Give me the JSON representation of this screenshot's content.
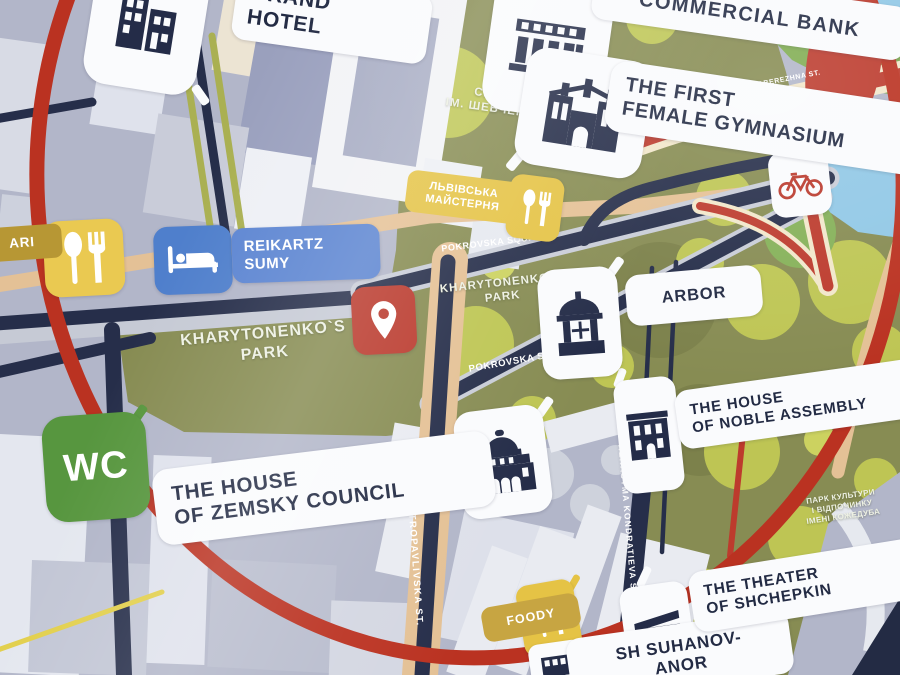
{
  "pois": {
    "grand_hotel": {
      "line1": "GRAND",
      "line2": "HOTEL",
      "icon": "modern-building"
    },
    "commercial_bank": {
      "label": "COMMERCIAL BANK",
      "icon": "bank-building"
    },
    "first_female_gymnasium": {
      "line1": "THE FIRST",
      "line2": "FEMALE GYMNASIUM",
      "icon": "towered-building"
    },
    "lvivska_maisternia": {
      "line1": "ЛЬВІВСЬКА",
      "line2": "МАЙСТЕРНЯ",
      "icon": "spoon-fork"
    },
    "restaurant_left": {
      "label": "ARI",
      "icon": "spoon-fork"
    },
    "reikartz_sumy": {
      "line1": "REIKARTZ",
      "line2": "SUMY",
      "icon": "bed"
    },
    "you_are_here": {
      "icon": "location-pin"
    },
    "arbor": {
      "label": "ARBOR",
      "icon": "gazebo"
    },
    "noble_assembly": {
      "line1": "THE HOUSE",
      "line2": "OF NOBLE ASSEMBLY",
      "icon": "mansion"
    },
    "wc": {
      "label": "WC"
    },
    "zemsky_council": {
      "line1": "THE HOUSE",
      "line2": "OF ZEMSKY COUNCIL",
      "icon": "domed-building"
    },
    "foody": {
      "label": "FOODY",
      "icon": "spoon-fork"
    },
    "theater_shchepkin": {
      "line1": "THE THEATER",
      "line2": "OF SHCHEPKIN",
      "icon": "theater-building"
    },
    "suhanov_manor": {
      "line1": "SH SUHANOV-",
      "line2": "ANOR",
      "icon": "building"
    },
    "bike_point": {
      "icon": "bicycle"
    },
    "route_marker": {
      "icon": "route-squiggle"
    }
  },
  "areas": {
    "shevchenko_square": {
      "line1": "СКВЕР",
      "line2": "ІМ. ШЕВЧЕНКА"
    },
    "kharytonenko_park": {
      "line1": "KHARYTONENKO`S",
      "line2": "PARK"
    },
    "kozhedub_park": {
      "line1": "ПАРК КУЛЬТУРИ",
      "line2": "І ВІДПОЧИНКУ",
      "line3": "ІМЕНІ КОЖЕДУБА"
    }
  },
  "streets": {
    "pokrovska_square": "POKROVSKA SQUARE",
    "petropavlivska": "PETROPAVLIVSKA ST.",
    "herasyma_kondratieva": "HERASYMA KONDRATIEVA ST.",
    "naberezhna": "NABEREZHNA ST."
  },
  "colors": {
    "building_field": "#b2b6ca",
    "park_olive": "#878c50",
    "tree_green": "#bec64f",
    "road_navy": "#262e4b",
    "road_tan": "#e6c193",
    "road_cream": "#f2e7c9",
    "route_red": "#c23a2b",
    "ring_red": "#c0311f",
    "water_blue": "#8fc8e8",
    "label_bg": "#fafbfd",
    "label_text": "#232b45",
    "poi_yellow": "#ecc94b",
    "poi_blue": "#4d7fd0",
    "poi_green": "#55973b",
    "poi_red": "#c0392b",
    "label_mustard": "#c9a53d"
  }
}
